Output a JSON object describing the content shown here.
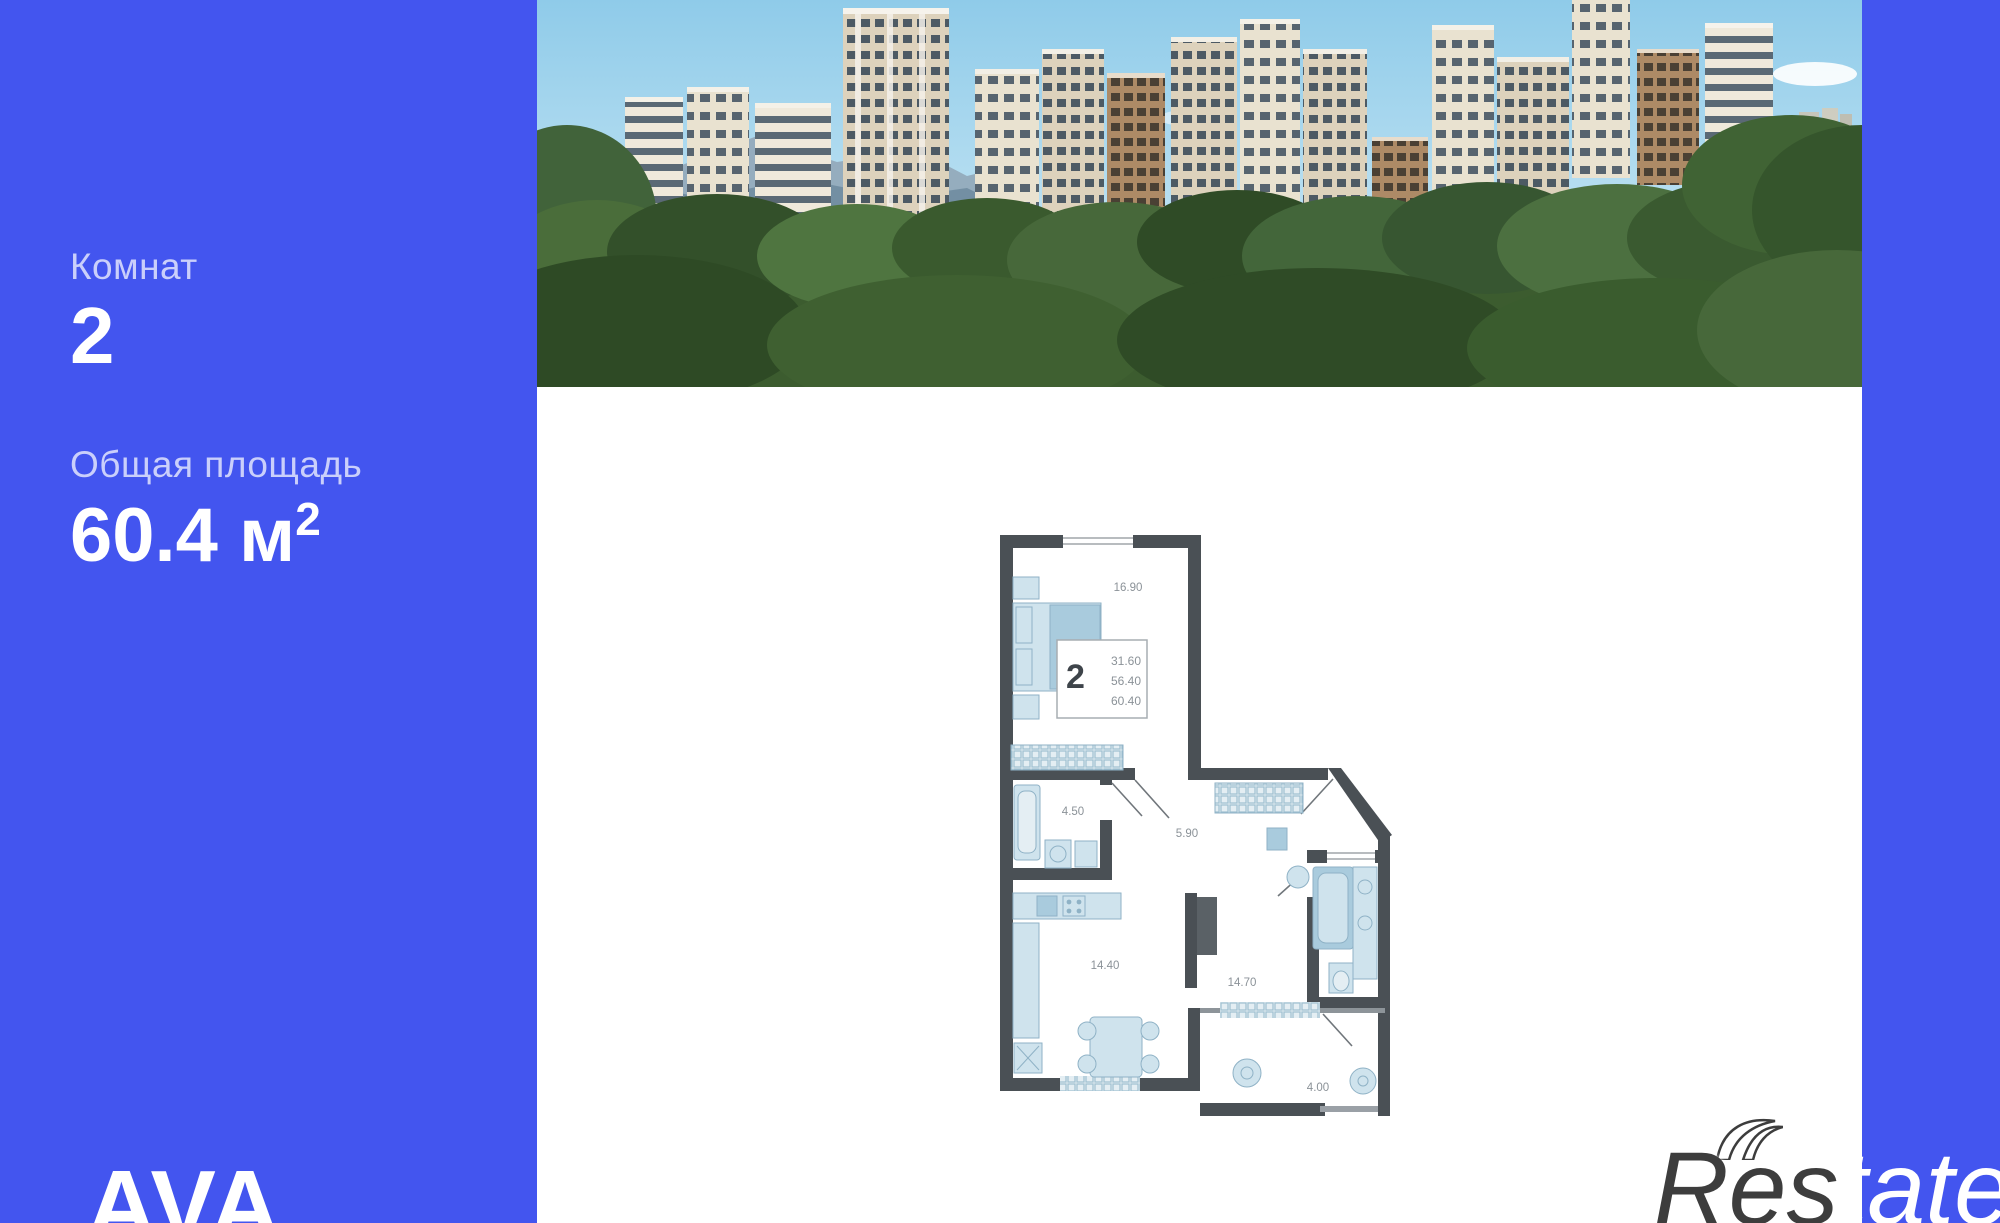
{
  "sidebar": {
    "rooms_label": "Комнат",
    "rooms_value": "2",
    "area_label": "Общая площадь",
    "area_value": "60.4 м",
    "area_sup": "2",
    "logo": "AVA"
  },
  "floor_plan": {
    "summary": {
      "rooms": "2",
      "living_area": "31.60",
      "area_without_balcony": "56.40",
      "total_area": "60.40"
    },
    "room_labels": [
      {
        "room": "bedroom",
        "area": "16.90"
      },
      {
        "room": "bathroom",
        "area": "4.50"
      },
      {
        "room": "hallway",
        "area": "5.90"
      },
      {
        "room": "kitchen",
        "area": "14.40"
      },
      {
        "room": "living-room",
        "area": "14.70"
      },
      {
        "room": "balcony",
        "area": "4.00"
      }
    ]
  },
  "watermark": {
    "left": "Res",
    "right": "tate"
  },
  "colors": {
    "background": "#4355ef",
    "panel": "#ffffff",
    "muted_label": "#b9c3f8",
    "plan_wall": "#4a5055",
    "plan_fixture": "#cfe3ed",
    "watermark_dark": "#3d3d3d"
  }
}
